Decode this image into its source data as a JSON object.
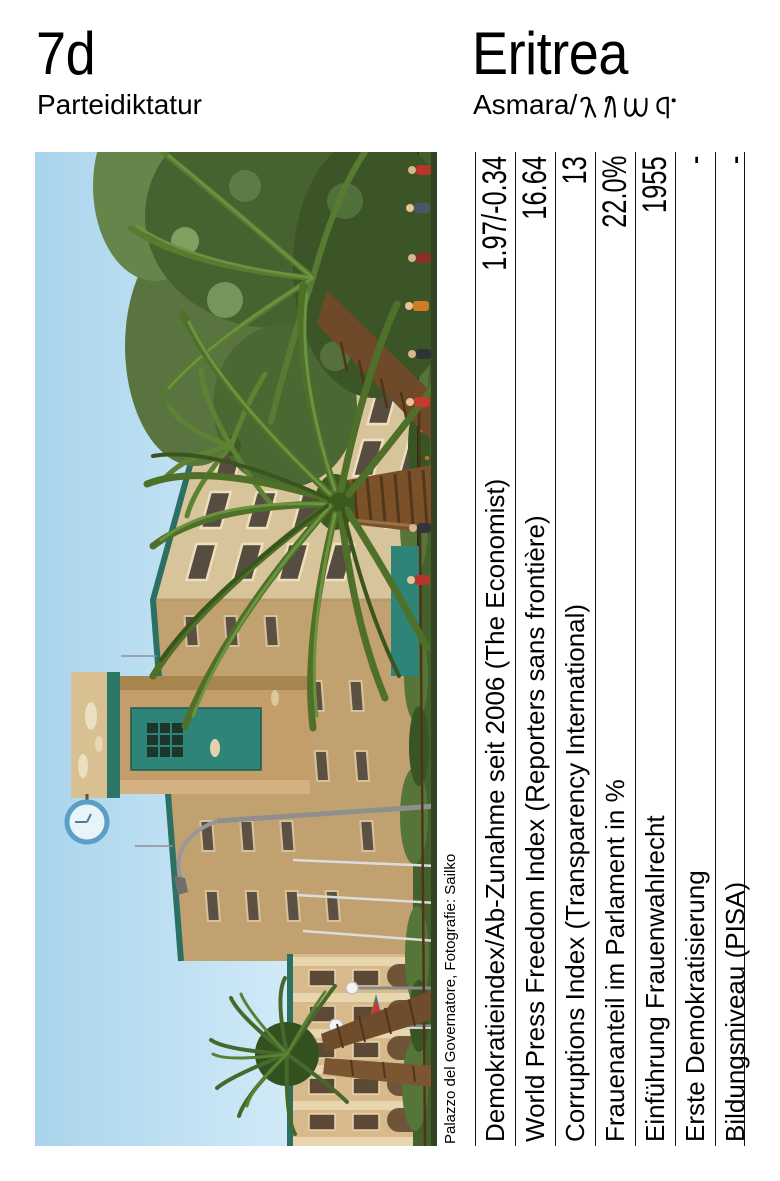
{
  "header": {
    "code": "7d",
    "category": "Parteidiktatur",
    "country": "Eritrea",
    "capital_latin": "Asmara/",
    "capital_geez": "ኣስመራ"
  },
  "photo": {
    "credit": "Palazzo del Governatore, Fotografie: Sailko",
    "palette": {
      "sky": "#aed9ef",
      "facade_light": "#d8c49a",
      "facade_shade": "#c2a171",
      "roof_teal": "#2c6f63",
      "tower_panel_teal": "#2f8478",
      "palm_green": "#4e7028",
      "trunk_brown": "#7b5129",
      "hedge_green": "#44602d",
      "clock_blue": "#5b9fc6"
    }
  },
  "table": {
    "rows": [
      {
        "label": "Demokratieindex/Ab-Zunahme seit 2006 (The Economist)",
        "value": "1.97/-0.34"
      },
      {
        "label": "World Press Freedom Index (Reporters sans frontière)",
        "value": "16.64"
      },
      {
        "label": "Corruptions Index (Transparency International)",
        "value": "13"
      },
      {
        "label": "Frauenanteil im Parlament in %",
        "value": "22.0%"
      },
      {
        "label": "Einführung Frauenwahlrecht",
        "value": "1955"
      },
      {
        "label": "Erste Demokratisierung",
        "value": "-"
      },
      {
        "label": "Bildungsniveau (PISA)",
        "value": "-"
      }
    ]
  }
}
